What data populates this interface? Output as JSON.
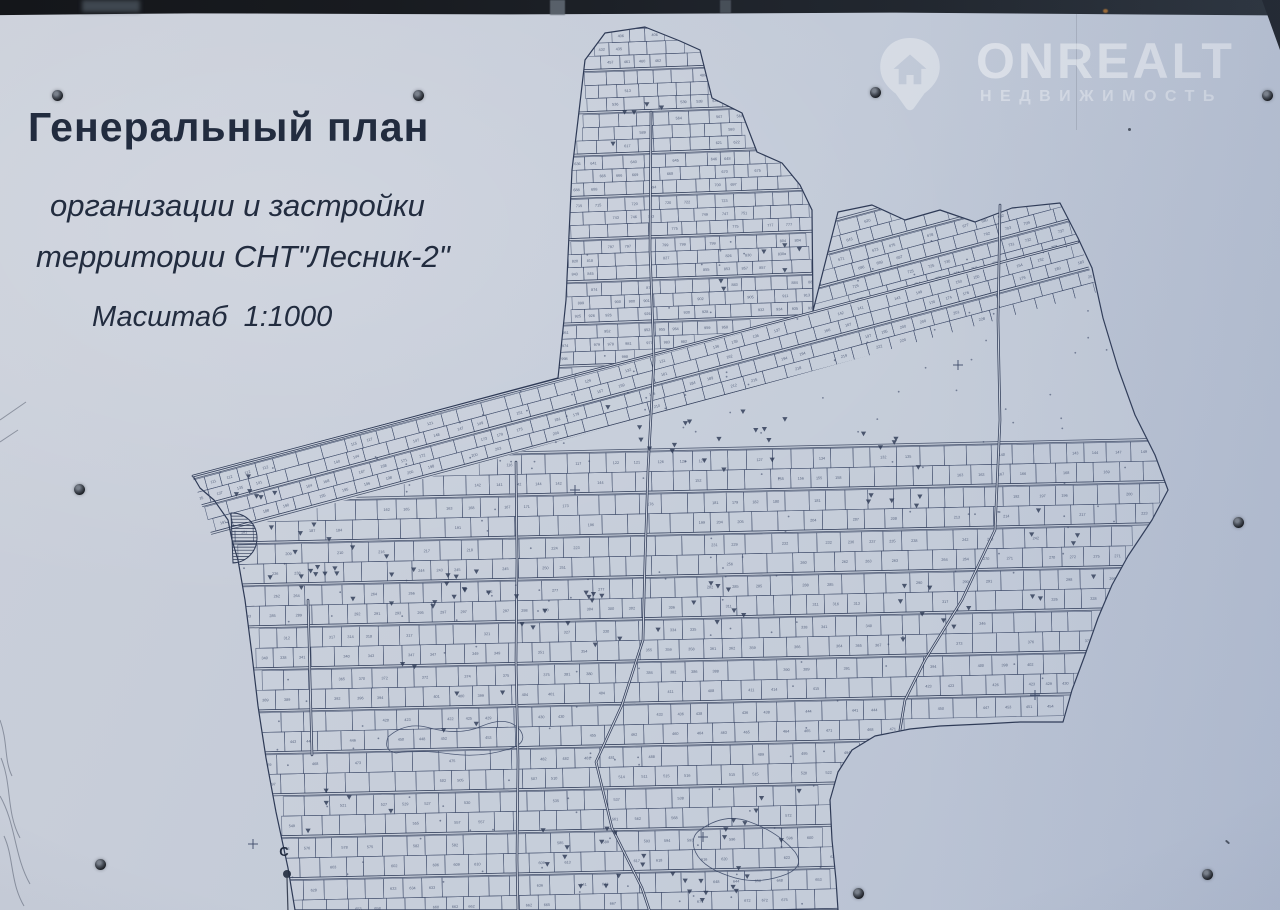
{
  "title": {
    "line1": "Генеральный план",
    "line2": "организации и застройки",
    "line3": "территории СНТ\"Лесник-2\"",
    "line4": "Масштаб  1:1000"
  },
  "watermark": {
    "brand": "ONREALT",
    "subtitle": "НЕДВИЖИМОСТЬ",
    "icon": "house-pin-icon"
  },
  "map": {
    "north_label": "С",
    "boundary": [
      [
        193,
        476
      ],
      [
        558,
        378
      ],
      [
        566,
        300
      ],
      [
        572,
        170
      ],
      [
        578,
        120
      ],
      [
        585,
        60
      ],
      [
        605,
        33
      ],
      [
        645,
        27
      ],
      [
        680,
        41
      ],
      [
        700,
        50
      ],
      [
        712,
        98
      ],
      [
        742,
        113
      ],
      [
        757,
        152
      ],
      [
        782,
        163
      ],
      [
        800,
        185
      ],
      [
        812,
        210
      ],
      [
        813,
        311
      ],
      [
        838,
        212
      ],
      [
        872,
        205
      ],
      [
        905,
        220
      ],
      [
        940,
        210
      ],
      [
        975,
        222
      ],
      [
        1012,
        208
      ],
      [
        1060,
        203
      ],
      [
        1078,
        238
      ],
      [
        1092,
        268
      ],
      [
        1103,
        318
      ],
      [
        1118,
        368
      ],
      [
        1135,
        415
      ],
      [
        1155,
        455
      ],
      [
        1168,
        490
      ],
      [
        1152,
        520
      ],
      [
        1128,
        556
      ],
      [
        1112,
        585
      ],
      [
        1098,
        618
      ],
      [
        1085,
        655
      ],
      [
        1072,
        690
      ],
      [
        1063,
        722
      ],
      [
        1020,
        722
      ],
      [
        983,
        724
      ],
      [
        940,
        726
      ],
      [
        910,
        729
      ],
      [
        875,
        736
      ],
      [
        852,
        750
      ],
      [
        838,
        772
      ],
      [
        830,
        800
      ],
      [
        832,
        840
      ],
      [
        836,
        880
      ],
      [
        838,
        910
      ],
      [
        295,
        910
      ],
      [
        288,
        868
      ],
      [
        276,
        812
      ],
      [
        266,
        758
      ],
      [
        258,
        706
      ],
      [
        252,
        655
      ],
      [
        245,
        600
      ],
      [
        238,
        560
      ],
      [
        232,
        540
      ],
      [
        228,
        520
      ],
      [
        214,
        500
      ],
      [
        200,
        488
      ]
    ],
    "clips": {
      "lobe": [
        [
          558,
          378
        ],
        [
          566,
          300
        ],
        [
          572,
          170
        ],
        [
          578,
          120
        ],
        [
          585,
          60
        ],
        [
          605,
          33
        ],
        [
          645,
          27
        ],
        [
          680,
          41
        ],
        [
          700,
          50
        ],
        [
          712,
          98
        ],
        [
          742,
          113
        ],
        [
          757,
          152
        ],
        [
          782,
          163
        ],
        [
          800,
          185
        ],
        [
          812,
          210
        ],
        [
          813,
          311
        ]
      ],
      "band": [
        [
          813,
          311
        ],
        [
          838,
          212
        ],
        [
          872,
          205
        ],
        [
          905,
          220
        ],
        [
          940,
          210
        ],
        [
          975,
          222
        ],
        [
          1012,
          208
        ],
        [
          1060,
          203
        ],
        [
          1078,
          238
        ],
        [
          1080,
          244
        ]
      ],
      "diagband": [
        [
          193,
          478
        ],
        [
          1080,
          244
        ],
        [
          1098,
          292
        ],
        [
          212,
          537
        ]
      ],
      "mainlow": [
        [
          212,
          537
        ],
        [
          1096,
          294
        ],
        [
          1103,
          318
        ],
        [
          1118,
          368
        ],
        [
          1135,
          415
        ],
        [
          1155,
          455
        ],
        [
          1168,
          490
        ],
        [
          1152,
          520
        ],
        [
          1128,
          556
        ],
        [
          1112,
          585
        ],
        [
          1098,
          618
        ],
        [
          1085,
          655
        ],
        [
          1072,
          690
        ],
        [
          1063,
          722
        ],
        [
          1020,
          722
        ],
        [
          983,
          724
        ],
        [
          940,
          726
        ],
        [
          910,
          729
        ],
        [
          875,
          736
        ],
        [
          852,
          750
        ],
        [
          838,
          772
        ],
        [
          830,
          800
        ],
        [
          832,
          840
        ],
        [
          836,
          880
        ],
        [
          838,
          912
        ],
        [
          295,
          912
        ],
        [
          288,
          868
        ],
        [
          276,
          812
        ],
        [
          266,
          758
        ],
        [
          258,
          706
        ],
        [
          252,
          655
        ],
        [
          245,
          600
        ],
        [
          238,
          560
        ],
        [
          232,
          540
        ],
        [
          228,
          520
        ]
      ]
    },
    "regions": [
      {
        "clip": "lobe",
        "angle": -2,
        "pivot": [
          686,
          200
        ],
        "pitch": 13,
        "x0": 550,
        "x1": 820,
        "y0": 24,
        "y1": 384,
        "cw": [
          13,
          22
        ],
        "streetEvery": 3,
        "base": 400,
        "seed": 7
      },
      {
        "clip": "band",
        "angle": -15,
        "pivot": [
          990,
          250
        ],
        "pitch": 13.5,
        "x0": 760,
        "x1": 1240,
        "y0": 150,
        "y1": 345,
        "cw": [
          14,
          24
        ],
        "streetEvery": 2,
        "base": 560,
        "seed": 11
      },
      {
        "clip": "diagband",
        "angle": -15,
        "pivot": [
          640,
          390
        ],
        "pitch": 13,
        "x0": 140,
        "x1": 1190,
        "y0": 300,
        "y1": 520,
        "cw": [
          15,
          26
        ],
        "streetEvery": 2,
        "base": 1,
        "seed": 13
      },
      {
        "clip": "mainlow",
        "angle": -1.2,
        "pivot": [
          700,
          680
        ],
        "pitch": 19.5,
        "x0": 215,
        "x1": 1185,
        "y0": 448,
        "y1": 918,
        "cw": [
          16,
          27
        ],
        "streetEvery": 2,
        "base": 100,
        "seed": 17
      }
    ],
    "roads": [
      [
        [
          193,
          476
        ],
        [
          1078,
          242
        ]
      ],
      [
        [
          651,
          112
        ],
        [
          650,
          250
        ],
        [
          654,
          360
        ],
        [
          648,
          470
        ],
        [
          645,
          560
        ],
        [
          643,
          640
        ],
        [
          622,
          705
        ],
        [
          596,
          762
        ],
        [
          612,
          828
        ],
        [
          642,
          888
        ],
        [
          650,
          912
        ]
      ],
      [
        [
          516,
          462
        ],
        [
          517,
          560
        ],
        [
          516,
          660
        ],
        [
          518,
          760
        ],
        [
          517,
          860
        ],
        [
          518,
          912
        ]
      ],
      [
        [
          308,
          600
        ],
        [
          312,
          755
        ]
      ],
      [
        [
          1000,
          205
        ],
        [
          998,
          320
        ],
        [
          1000,
          420
        ],
        [
          995,
          530
        ],
        [
          962,
          600
        ],
        [
          925,
          660
        ],
        [
          905,
          700
        ],
        [
          900,
          730
        ]
      ]
    ],
    "tree_clusters": [
      [
        330,
        555,
        60,
        35,
        16
      ],
      [
        420,
        590,
        70,
        30,
        14
      ],
      [
        560,
        620,
        60,
        28,
        12
      ],
      [
        650,
        430,
        50,
        25,
        8
      ],
      [
        760,
        440,
        60,
        30,
        9
      ],
      [
        700,
        600,
        50,
        30,
        8
      ],
      [
        880,
        470,
        40,
        40,
        10
      ],
      [
        930,
        620,
        40,
        40,
        8
      ],
      [
        600,
        860,
        60,
        35,
        12
      ],
      [
        700,
        880,
        50,
        25,
        10
      ],
      [
        760,
        820,
        40,
        30,
        8
      ],
      [
        260,
        490,
        30,
        20,
        6
      ],
      [
        640,
        140,
        30,
        40,
        5
      ],
      [
        760,
        260,
        40,
        40,
        6
      ],
      [
        1060,
        560,
        40,
        50,
        7
      ],
      [
        980,
        760,
        50,
        40,
        8
      ],
      [
        450,
        700,
        60,
        40,
        6
      ],
      [
        350,
        800,
        50,
        40,
        5
      ]
    ],
    "crosses": [
      [
        958,
        365
      ],
      [
        253,
        844
      ],
      [
        703,
        837
      ],
      [
        1035,
        695
      ],
      [
        575,
        490
      ]
    ],
    "hatch_area": {
      "cx": 232,
      "cy": 538,
      "r": 25
    }
  },
  "photo": {
    "screws": [
      [
        57,
        95
      ],
      [
        418,
        95
      ],
      [
        875,
        92
      ],
      [
        1267,
        95
      ],
      [
        79,
        489
      ],
      [
        1238,
        522
      ],
      [
        100,
        864
      ],
      [
        858,
        893
      ],
      [
        1207,
        874
      ]
    ]
  },
  "colors": {
    "line": "#3d4a68",
    "road": "#2e3a56",
    "ink": "#222c3f",
    "map_fill": "#cbd1dd",
    "screw": "#1d2127"
  }
}
